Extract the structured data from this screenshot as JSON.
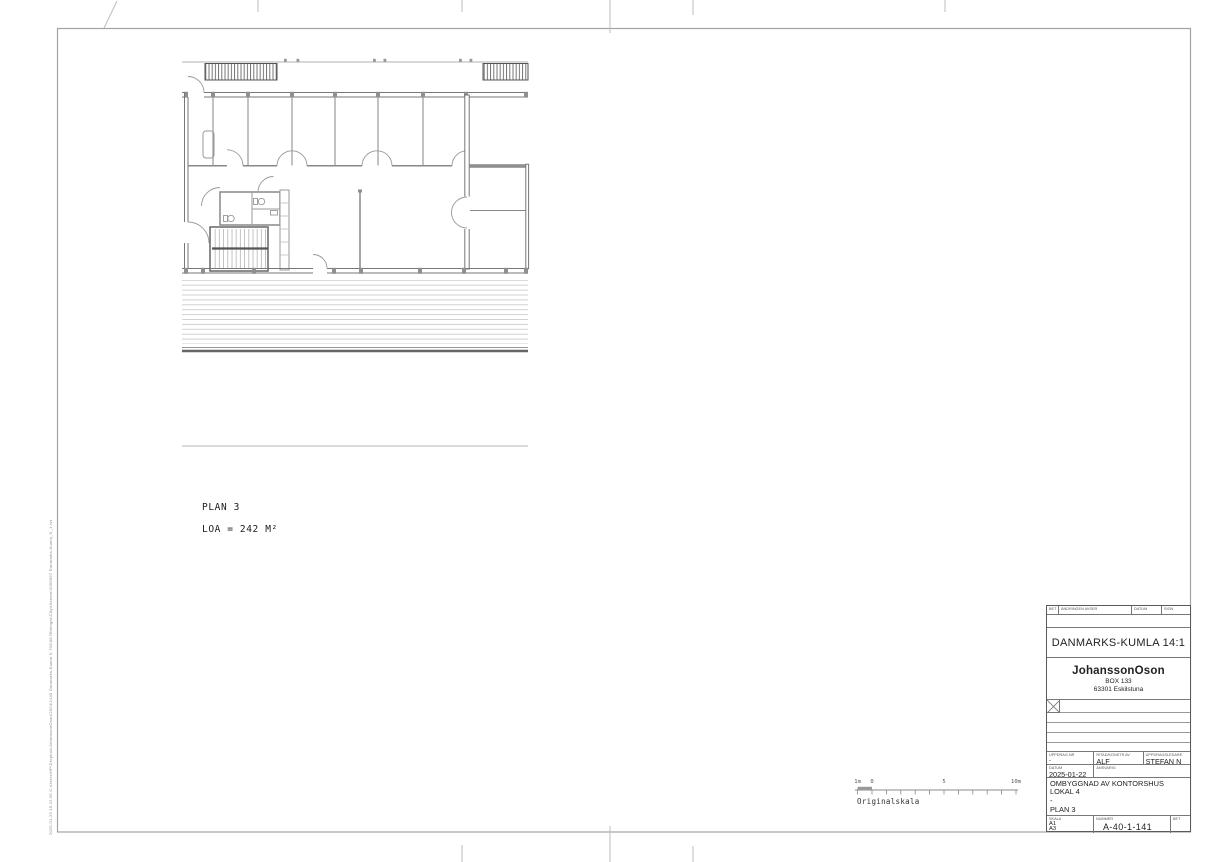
{
  "document": {
    "plan_label": "PLAN 3",
    "area_label": "LOA = 242 M²",
    "originalskala": "Originalskala",
    "scalebar": {
      "m1": "1m",
      "zero": "0",
      "five": "5",
      "ten": "10m"
    },
    "plot_stamp": "2025-01-29 15:22:26      C:\\Users\\HP\\Dropbox\\JohanssonOson\\2024\\2140 Danmarks-Kumla N 703\\08 Ritningar\\City\\Utvevar\\1009697 Danmarks-Kumla_N_1.rvt"
  },
  "titleblock": {
    "rev_header": {
      "bet": "BET",
      "andringen_avser": "ÄNDRINGEN AVSER",
      "datum": "DATUM",
      "sign": "SIGN"
    },
    "property": "DANMARKS-KUMLA 14:1",
    "company": {
      "name": "JohanssonOson",
      "box": "BOX 133",
      "city": "63301 Eskilstuna"
    },
    "fields": {
      "uppdrag_nr_label": "UPPDRAG.NR",
      "uppdrag_nr": "-",
      "ritad_label": "RITAD/KONSTR AV",
      "ritad": "ALF",
      "ledare_label": "UPPDRAGSLEDARE",
      "ledare": "STEFAN N",
      "datum_label": "DATUM",
      "datum": "2025-01-22",
      "ansvarig_label": "ANSVARIG",
      "ansvarig": "",
      "title1": "OMBYGGNAD AV KONTORSHUS",
      "title2": "LOKAL 4",
      "title3": "-",
      "title4": "PLAN 3",
      "skala_label": "SKALA",
      "skala1": "A1",
      "skala2": "A3",
      "nummer_label": "NUMMER",
      "nummer": "A-40-1-141",
      "bet_label": "BET",
      "bet": ""
    }
  }
}
